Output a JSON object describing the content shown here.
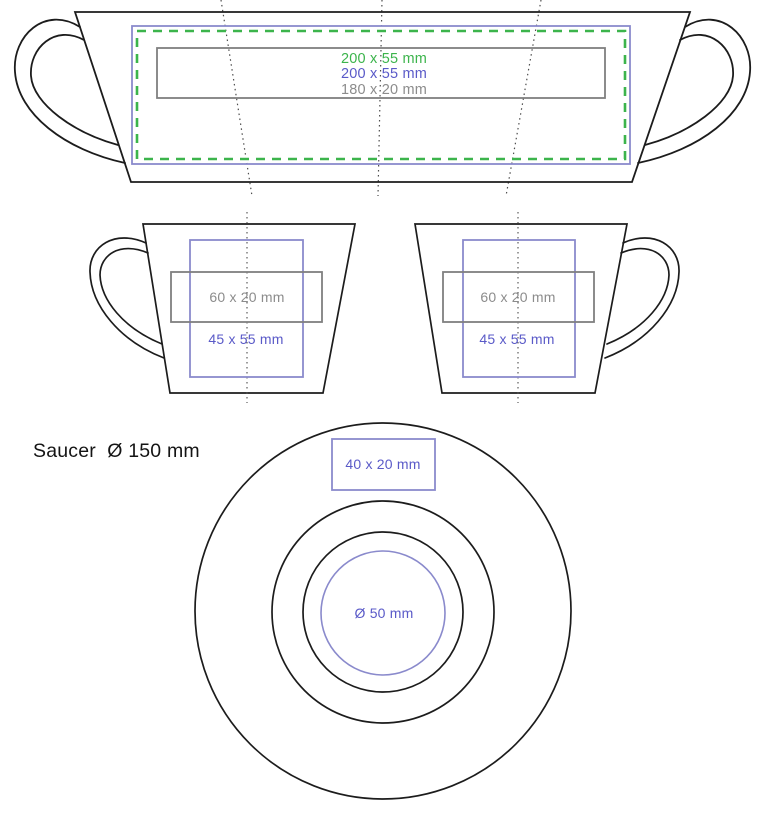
{
  "colors": {
    "outline": "#1c1c1c",
    "gray_stroke": "#808080",
    "gray_text": "#8c8c8c",
    "blue_stroke": "#8a8acc",
    "blue_text": "#5a5ac8",
    "green": "#3cb44c",
    "guide_dotted": "#4d4d4d"
  },
  "flattened_cup": {
    "print_areas": [
      {
        "label": "200 x 55 mm",
        "color": "green",
        "border_style": "dashed"
      },
      {
        "label": "200 x 55 mm",
        "color": "blue",
        "border_style": "solid"
      },
      {
        "label": "180 x 20 mm",
        "color": "gray",
        "border_style": "solid"
      }
    ]
  },
  "cup_left_view": {
    "print_areas": [
      {
        "label": "60 x 20 mm",
        "color": "gray"
      },
      {
        "label": "45 x 55 mm",
        "color": "blue"
      }
    ]
  },
  "cup_right_view": {
    "print_areas": [
      {
        "label": "60 x 20 mm",
        "color": "gray"
      },
      {
        "label": "45 x 55 mm",
        "color": "blue"
      }
    ]
  },
  "saucer": {
    "caption": "Saucer  Ø 150 mm",
    "diameter": "150 mm",
    "top_print_area": {
      "label": "40 x 20 mm",
      "color": "blue"
    },
    "center_print_area": {
      "label": "Ø 50 mm",
      "color": "blue"
    }
  }
}
